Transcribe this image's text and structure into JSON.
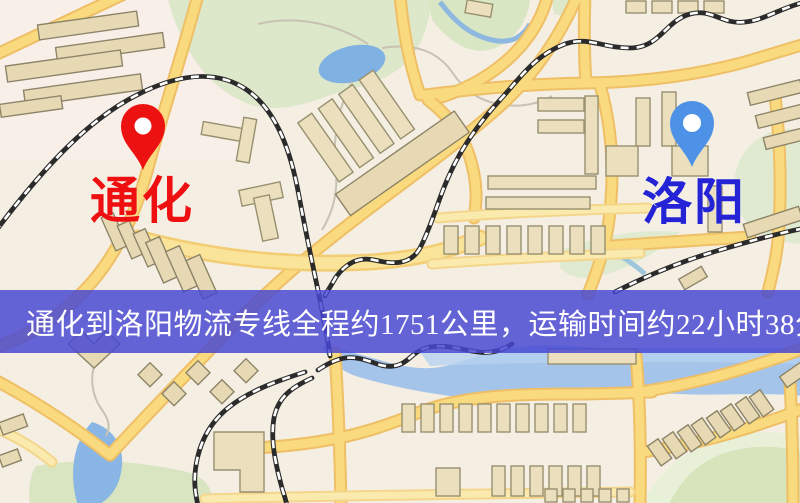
{
  "map": {
    "origin": {
      "name": "通化",
      "marker_color": "#ed1212",
      "label_color": "#ee1010"
    },
    "destination": {
      "name": "洛阳",
      "marker_color": "#4e92e8",
      "label_color": "#2424d6"
    }
  },
  "banner": {
    "text": "通化到洛阳物流专线全程约1751公里，运输时间约22小时38分钟.",
    "distance_text": "约1751公里",
    "duration_text": "约22小时38分钟",
    "background": "#4848d3",
    "text_color": "#ffffff"
  },
  "palette": {
    "map_background": "#f5efe3",
    "road_fill": "#f9da7e",
    "road_casing": "#efbf66",
    "park_green": "#dde7c9",
    "water_blue": "#7fb1e2",
    "river_blue": "#a5c4ea",
    "building_tan": "#ebdfbe",
    "railway_black": "#2b2b2b"
  }
}
